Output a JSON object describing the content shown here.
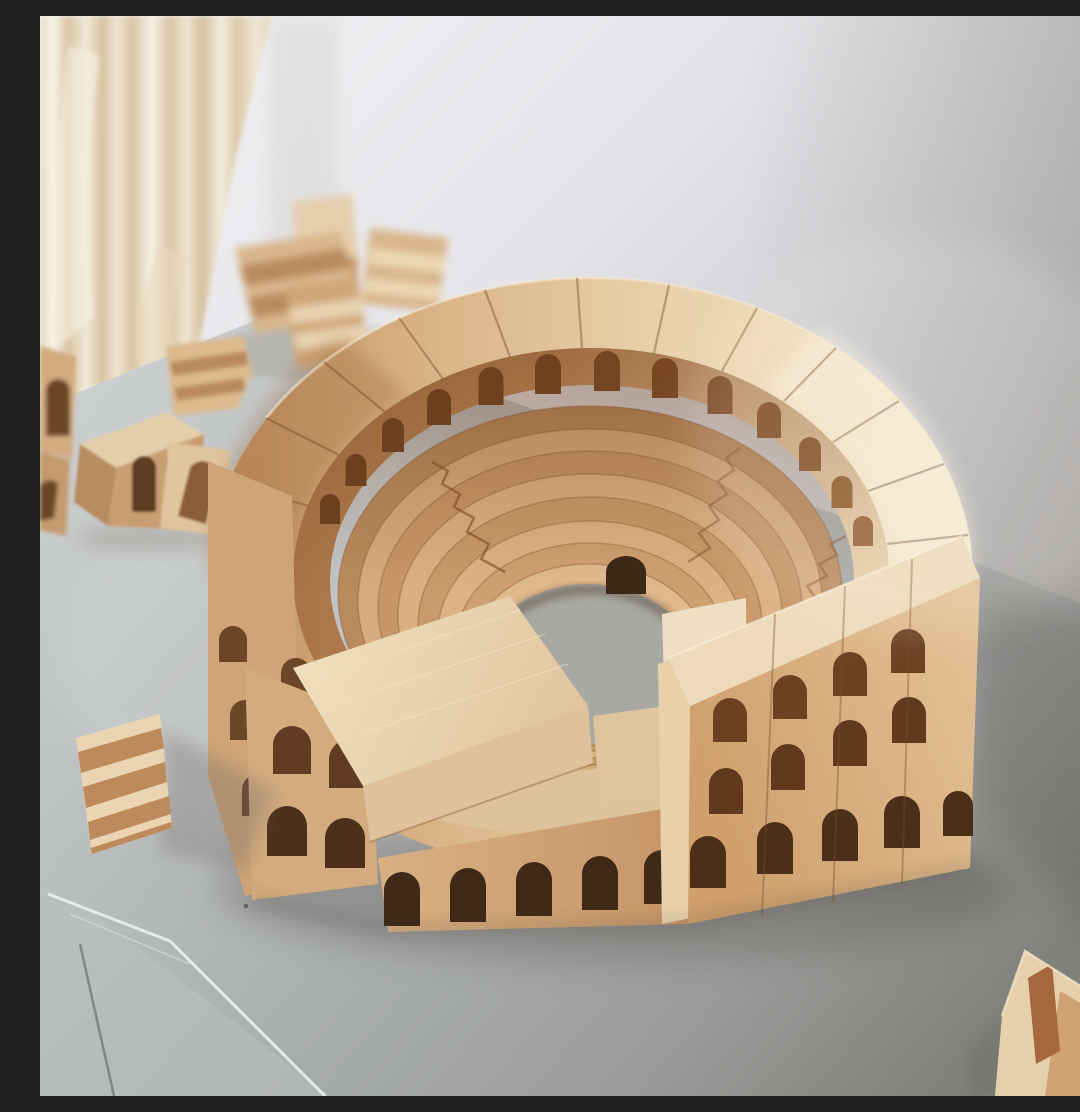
{
  "scene": {
    "type": "photograph",
    "description": "Natural-wood toy building blocks assembled into a round Colosseum-style amphitheater standing on a gray table; spare staircase and arch blocks are scattered around it, with a cream curtain and a white wall softly blurred in the background",
    "lighting": "soft daylight from the upper right, shadow falling toward the lower right",
    "focus": "colosseum sharp, background blocks and curtain out of focus"
  },
  "palette": {
    "wall_light": "#f2f3f5",
    "wall_mid": "#d6d7da",
    "wall_shadow": "#8f8a83",
    "curtain_base": "#ece3d2",
    "curtain_fold": "#d8c4a4",
    "curtain_highlight": "#f7f2e6",
    "table_light": "#d0d3d4",
    "table_mid": "#b3b6b7",
    "table_dark": "#9a9c9a",
    "table_deep": "#7f817b",
    "table_edge_highlight": "#eceeee",
    "arena_floor": "#a8a9a3",
    "wood_pale": "#eedcbc",
    "wood_light": "#e2c69e",
    "wood_mid": "#d1a577",
    "wood_warm": "#c08c5c",
    "wood_dark": "#a87248",
    "wood_deep": "#8a5a36",
    "arch_shadow": "#5e3a20",
    "arch_black": "#3c2817",
    "seam": "#6f4829"
  },
  "objects": [
    {
      "name": "curtain",
      "label": "cream pleated curtain, upper left, blurred"
    },
    {
      "name": "wall",
      "label": "white wall shading darker toward the right"
    },
    {
      "name": "table-surface",
      "label": "gray table top with front-left corner edge visible"
    },
    {
      "name": "colosseum-model",
      "label": "round amphitheater of beech blocks",
      "details": {
        "outer_rim_blocks": "curved wedge blocks forming the tall back wall",
        "arcade_windows": 13,
        "seating_tiers": 7,
        "staircase_aisles": 4,
        "arena": "oval table surface visible through the center",
        "arena_entrance_arch": 1,
        "left_facade_arch_rows": 2,
        "right_facade_arch_rows": 3,
        "ground_arches": "row of small arched doorways along the front base"
      }
    },
    {
      "name": "stair-block-cluster",
      "label": "pile of staircase blocks behind the model, blurred"
    },
    {
      "name": "arch-block-left",
      "label": "double-arch block lying on the left"
    },
    {
      "name": "stair-block-left",
      "label": "small staircase block on the left"
    },
    {
      "name": "notch-block-left",
      "label": "arch block on its side next to it"
    },
    {
      "name": "edge-arch-block",
      "label": "arch block cut off at the left edge"
    },
    {
      "name": "stair-block-front",
      "label": "staircase block standing at the lower left"
    },
    {
      "name": "notched-block-corner",
      "label": "double-notched block at the lower right corner"
    },
    {
      "name": "dust-speck",
      "label": "tiny speck on the table"
    }
  ]
}
